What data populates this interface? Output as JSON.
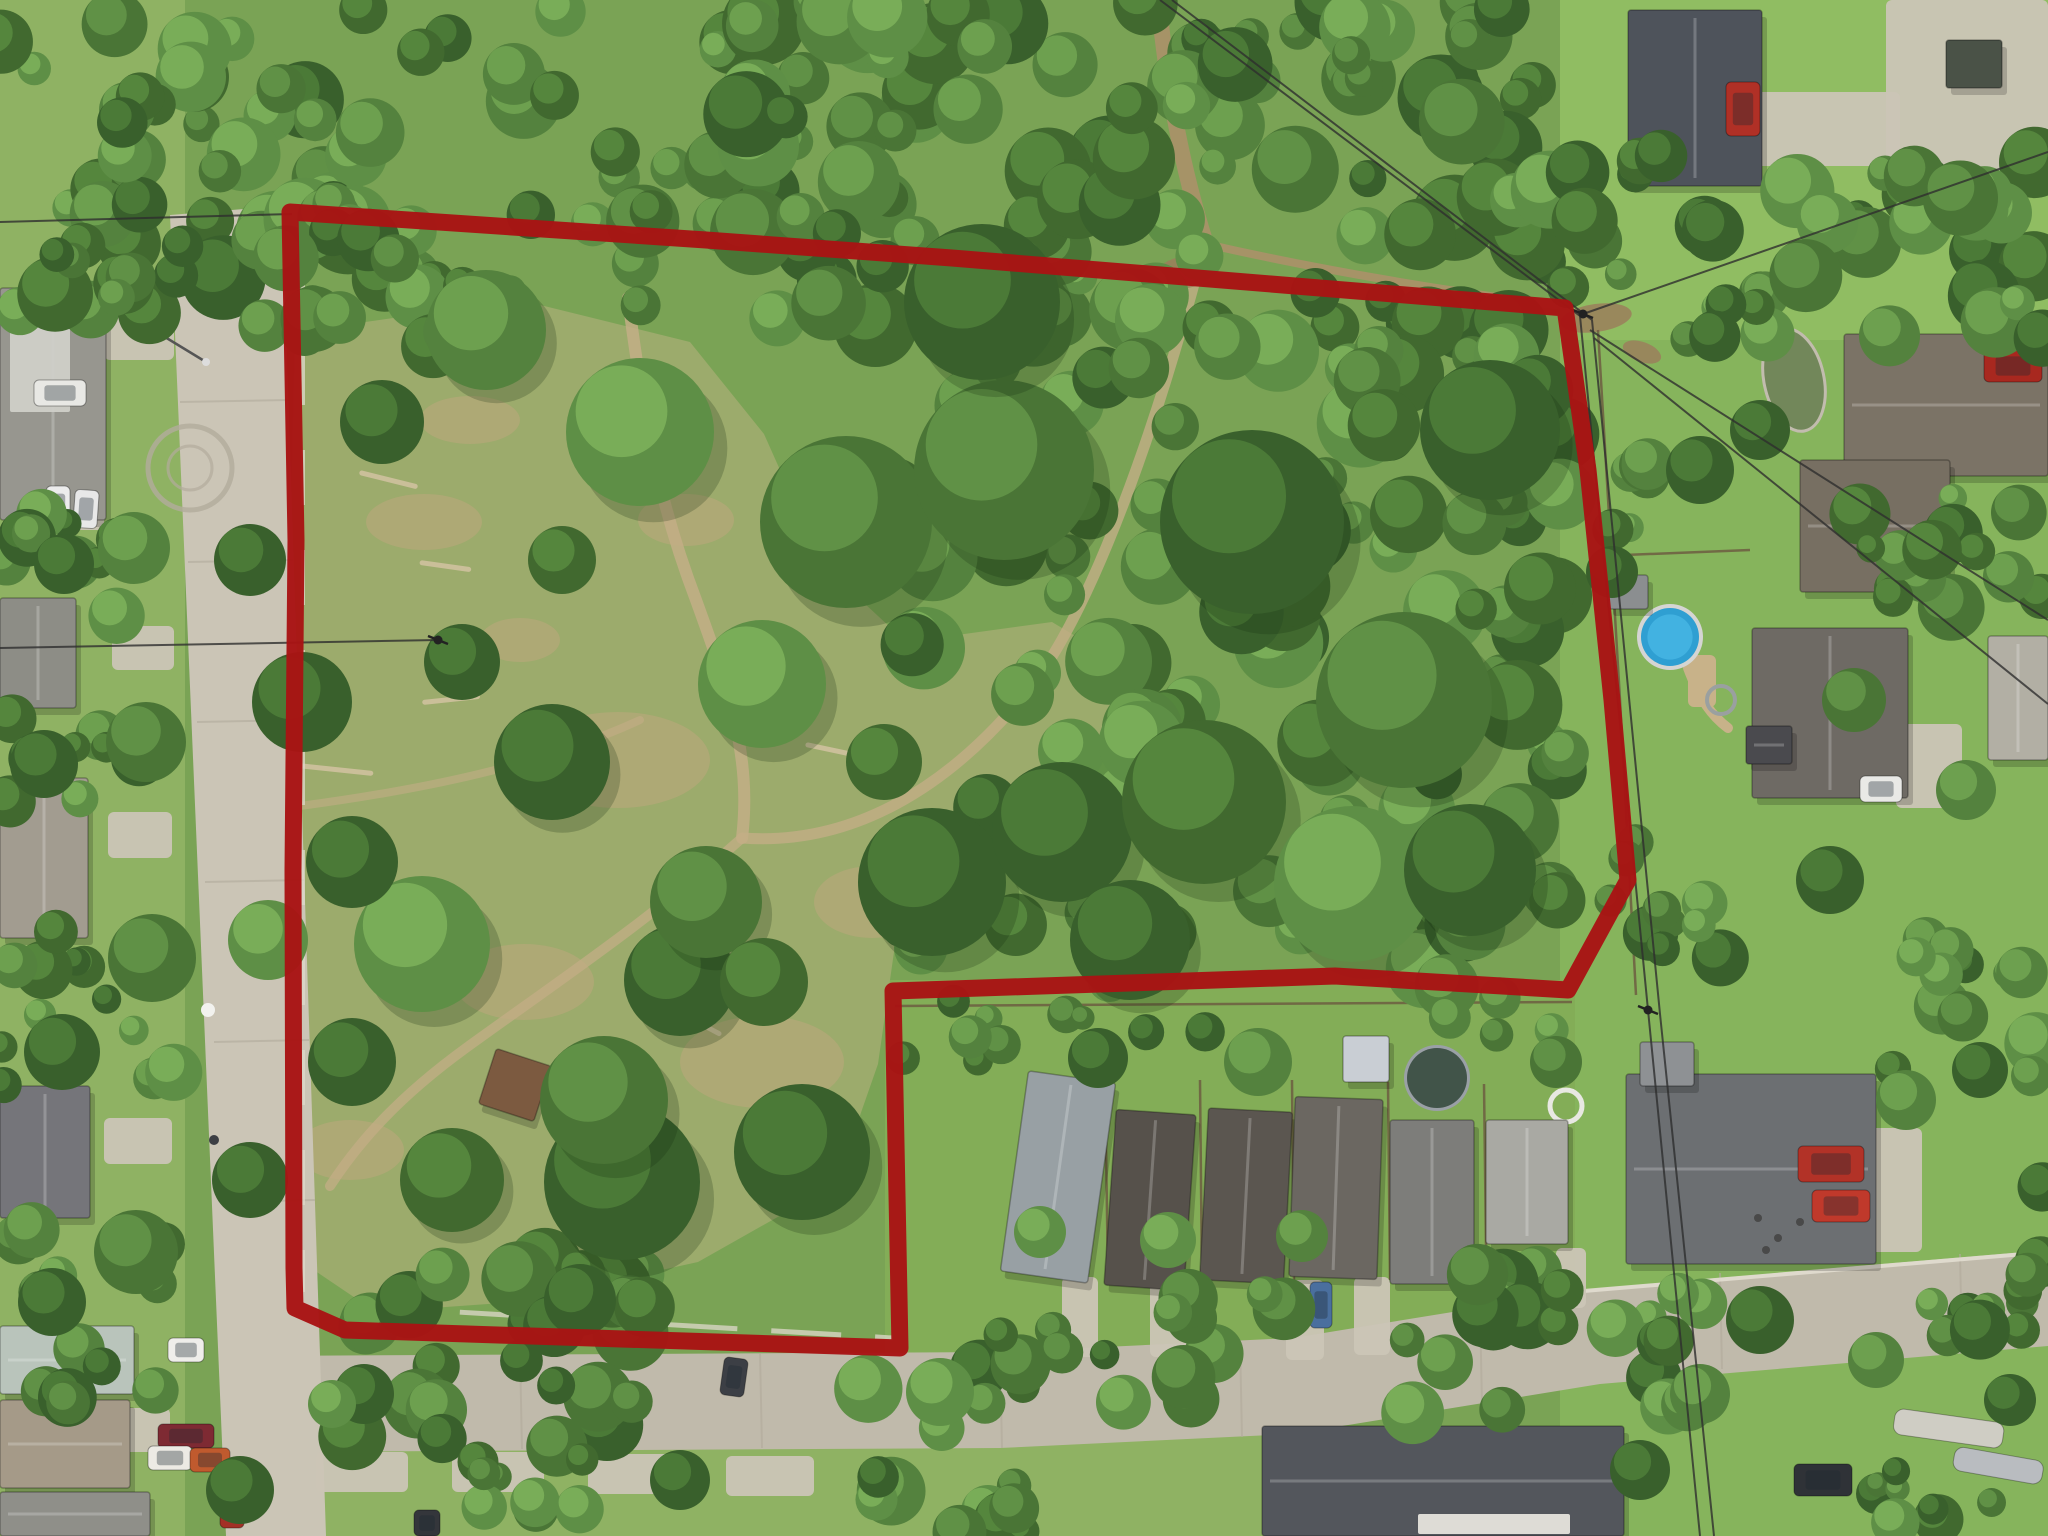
{
  "image": {
    "kind": "aerial-drone-photo",
    "width": 2048,
    "height": 1536,
    "description": "Aerial drone photo of a wooded vacant land parcel outlined with a thick dark-red boundary line, surrounded by suburban streets, houses, driveways, pools and lawns"
  },
  "palette": {
    "base": "#7aa355",
    "lawn_left": "#8fb263",
    "lawn_right": "#86b45c",
    "lawn_top_right": "#90bd62",
    "lawn_notch": "#83ad57",
    "clearing": "#9cab6c",
    "dry": "#bfa87e",
    "road": "#cbc5b6",
    "road_dark": "#c0baab",
    "curb": "#e3ded1",
    "seam": "#b2ab9c",
    "trail": "#c3ae86",
    "dirt": "#ab9169",
    "mud": "#9b7f5c",
    "log": "#cfc19f",
    "tree_dark": [
      "#39602c",
      "#41692f",
      "#4a7536",
      "#54823e",
      "#5e8f46"
    ],
    "tree_light": [
      "#4e7d39",
      "#58893f",
      "#639548",
      "#70a351",
      "#7cb05a"
    ],
    "boundary": "#a81414",
    "wire": "#2e2e2e",
    "fence": "#6b5740",
    "white_fence": "#ded9cb",
    "pool_water": "#2f9fd2",
    "pool_water_light": "#45b4e2",
    "pool_rim": "#d5d5d3",
    "dark_pool": "#415449",
    "dark_pool_rim": "#9aa0a6",
    "pond": "#72875a",
    "pond_rim": "#c2bcae",
    "deck": "#c8b289",
    "shadow": "rgba(0,0,0,0.18)",
    "ridge": "rgba(255,255,255,0.22)",
    "eave": "rgba(0,0,0,0.28)",
    "glass": "rgba(30,40,50,0.35)"
  },
  "boundary": {
    "stroke_width": 17,
    "points": [
      [
        290,
        212
      ],
      [
        706,
        240
      ],
      [
        952,
        258
      ],
      [
        1565,
        308
      ],
      [
        1588,
        470
      ],
      [
        1612,
        700
      ],
      [
        1628,
        880
      ],
      [
        1568,
        990
      ],
      [
        1335,
        976
      ],
      [
        893,
        991
      ],
      [
        900,
        1348
      ],
      [
        345,
        1330
      ],
      [
        295,
        1308
      ],
      [
        294,
        1268
      ],
      [
        293,
        870
      ],
      [
        296,
        540
      ]
    ]
  },
  "lawns": [
    [
      0,
      0,
      185,
      1536,
      "lawn_left"
    ],
    [
      1560,
      0,
      488,
      1536,
      "lawn_right"
    ],
    [
      1560,
      0,
      488,
      340,
      "lawn_top_right"
    ],
    [
      885,
      980,
      690,
      380,
      "lawn_notch"
    ],
    [
      230,
      1430,
      1330,
      106,
      "lawn_left"
    ]
  ],
  "clearing_path": "M295,332 L520,300 L690,342 L764,434 L822,564 L906,642 L1052,622 L1152,682 L1098,784 L962,834 L898,924 L878,1064 L836,1184 L698,1262 L516,1302 L376,1312 L302,1262 L284,802 Z",
  "dry_patches": [
    [
      618,
      760,
      92,
      48
    ],
    [
      524,
      982,
      70,
      38
    ],
    [
      762,
      1062,
      82,
      46
    ],
    [
      424,
      522,
      58,
      28
    ],
    [
      872,
      902,
      58,
      36
    ],
    [
      686,
      520,
      48,
      26
    ],
    [
      520,
      640,
      40,
      22
    ],
    [
      350,
      1150,
      54,
      30
    ],
    [
      470,
      420,
      50,
      24
    ]
  ],
  "trails": [
    {
      "d": "M628,298 C644,420 658,500 696,600 C728,688 752,756 742,838",
      "w": 12,
      "o": 0.85
    },
    {
      "d": "M742,838 C850,846 948,790 1030,688 C1094,608 1158,420 1200,262",
      "w": 11,
      "o": 0.8
    },
    {
      "d": "M742,838 C650,920 560,980 466,1048 C400,1096 360,1140 330,1186",
      "w": 10,
      "o": 0.75
    },
    {
      "d": "M300,806 C420,790 540,766 640,720",
      "w": 8,
      "o": 0.6
    }
  ],
  "dirt_paths": [
    {
      "d": "M1158,-6 C1166,84 1182,168 1206,244",
      "w": 16
    },
    {
      "d": "M1206,244 C1320,270 1450,292 1566,306",
      "w": 8
    }
  ],
  "mud_patches": [
    [
      1186,
      272,
      30,
      16,
      -8
    ],
    [
      1596,
      318,
      36,
      14,
      -8
    ],
    [
      1642,
      352,
      20,
      10,
      20
    ]
  ],
  "logs": [
    [
      742,
      688,
      74,
      -18
    ],
    [
      806,
      742,
      64,
      12
    ],
    [
      288,
      762,
      86,
      6
    ],
    [
      422,
      700,
      58,
      -6
    ],
    [
      868,
      906,
      54,
      20
    ],
    [
      680,
      1010,
      48,
      28
    ],
    [
      420,
      560,
      52,
      8
    ],
    [
      360,
      470,
      60,
      14
    ]
  ],
  "roads": {
    "left_street": "M170,215 L282,206 L326,1536 L226,1536 Z",
    "bottom_street": "M252,1356 L1000,1352 L1293,1338 L1600,1288 L2048,1250 L2048,1346 L1600,1384 L1293,1434 L1000,1448 L262,1452 Z",
    "seams": [
      [
        180,
        402,
        288,
        400
      ],
      [
        188,
        562,
        293,
        560
      ],
      [
        197,
        722,
        299,
        720
      ],
      [
        205,
        882,
        304,
        880
      ],
      [
        214,
        1042,
        309,
        1040
      ],
      [
        222,
        1202,
        315,
        1200
      ],
      [
        520,
        1354,
        522,
        1449
      ],
      [
        760,
        1353,
        762,
        1448
      ],
      [
        1000,
        1352,
        1002,
        1448
      ],
      [
        1240,
        1341,
        1242,
        1437
      ],
      [
        1480,
        1308,
        1482,
        1404
      ],
      [
        1720,
        1273,
        1722,
        1369
      ],
      [
        1960,
        1254,
        1962,
        1350
      ]
    ],
    "culdesac": {
      "cx": 190,
      "cy": 468,
      "r1": 42,
      "r2": 22
    },
    "curbs": [
      [
        1560,
        1293,
        2048,
        1252
      ]
    ]
  },
  "driveways": [
    [
      104,
      300,
      70,
      60
    ],
    [
      112,
      626,
      62,
      44
    ],
    [
      108,
      812,
      64,
      46
    ],
    [
      104,
      1118,
      68,
      46
    ],
    [
      100,
      1408,
      70,
      44
    ],
    [
      1754,
      92,
      146,
      74
    ],
    [
      1886,
      0,
      162,
      178
    ],
    [
      1896,
      724,
      66,
      84
    ],
    [
      1788,
      1128,
      134,
      124
    ],
    [
      1738,
      1198,
      96,
      66
    ],
    [
      1062,
      1277,
      36,
      80
    ],
    [
      1150,
      1283,
      38,
      74
    ],
    [
      1286,
      1280,
      38,
      80
    ],
    [
      1354,
      1277,
      36,
      78
    ],
    [
      1470,
      1260,
      32,
      66
    ],
    [
      1556,
      1248,
      30,
      60
    ],
    [
      316,
      1452,
      92,
      40
    ],
    [
      452,
      1452,
      92,
      40
    ],
    [
      588,
      1454,
      92,
      40
    ],
    [
      726,
      1456,
      88,
      40
    ],
    [
      40,
      486,
      64,
      44
    ]
  ],
  "white_fences": [
    {
      "x1": 303,
      "y1": 250,
      "x2": 303,
      "y2": 1292,
      "dash": "55 45",
      "w": 4
    },
    {
      "x1": 356,
      "y1": 1306,
      "x2": 893,
      "y2": 1338,
      "dash": "70 34",
      "w": 5
    }
  ],
  "fences": [
    [
      [
        1598,
        330
      ],
      [
        1620,
        700
      ],
      [
        1636,
        995
      ]
    ],
    [
      [
        895,
        1006
      ],
      [
        1572,
        1002
      ]
    ],
    [
      [
        1105,
        1077
      ],
      [
        1108,
        1280
      ]
    ],
    [
      [
        1200,
        1080
      ],
      [
        1202,
        1282
      ]
    ],
    [
      [
        1292,
        1080
      ],
      [
        1294,
        1280
      ]
    ],
    [
      [
        1388,
        1082
      ],
      [
        1390,
        1280
      ]
    ],
    [
      [
        1484,
        1084
      ],
      [
        1486,
        1246
      ]
    ],
    [
      [
        1600,
        556
      ],
      [
        1750,
        550
      ]
    ]
  ],
  "pond": {
    "cx": 1794,
    "cy": 380,
    "rx": 30,
    "ry": 52,
    "rot": -12
  },
  "pools": {
    "blue": {
      "cx": 1670,
      "cy": 637,
      "r": 29
    },
    "deck": [
      1688,
      655,
      28,
      52
    ],
    "slide": {
      "d": "M1688,668 C1700,700 1712,716 1728,728",
      "w": 10
    },
    "dark": {
      "cx": 1437,
      "cy": 1078,
      "r": 30
    },
    "trampoline": {
      "cx": 1721,
      "cy": 700,
      "r": 14
    },
    "white_ring": {
      "cx": 1566,
      "cy": 1106,
      "r": 16
    }
  },
  "houses": [
    [
      0,
      288,
      106,
      232,
      0,
      "#97968f"
    ],
    [
      0,
      598,
      76,
      110,
      0,
      "#8d8d86"
    ],
    [
      0,
      778,
      88,
      160,
      0,
      "#a29c90"
    ],
    [
      0,
      1086,
      90,
      132,
      0,
      "#75757a"
    ],
    [
      0,
      1326,
      134,
      68,
      0,
      "#b9c4bb"
    ],
    [
      0,
      1400,
      130,
      88,
      0,
      "#a59a88"
    ],
    [
      0,
      1492,
      150,
      44,
      0,
      "#8f8f89"
    ],
    [
      1628,
      10,
      134,
      176,
      0,
      "#4e535b"
    ],
    [
      1844,
      334,
      204,
      142,
      0,
      "#7b7366"
    ],
    [
      1800,
      460,
      150,
      132,
      0,
      "#776f62"
    ],
    [
      1752,
      628,
      156,
      170,
      0,
      "#6e6a64"
    ],
    [
      1746,
      726,
      46,
      38,
      0,
      "#4a4a4e"
    ],
    [
      1626,
      1074,
      250,
      190,
      0,
      "#6c6f72"
    ],
    [
      1262,
      1426,
      362,
      110,
      0,
      "#53565c"
    ],
    [
      1988,
      636,
      60,
      124,
      0,
      "#b2afa4"
    ],
    [
      1014,
      1076,
      88,
      202,
      8,
      "#98a0a4"
    ],
    [
      1110,
      1112,
      80,
      176,
      4,
      "#56514b"
    ],
    [
      1204,
      1110,
      84,
      172,
      3,
      "#5b5650"
    ],
    [
      1292,
      1098,
      88,
      180,
      2,
      "#6b6761"
    ],
    [
      1390,
      1120,
      84,
      164,
      0,
      "#7d7d7a"
    ],
    [
      1486,
      1120,
      82,
      124,
      0,
      "#a9a9a3"
    ]
  ],
  "house_details": [
    [
      10,
      292,
      60,
      120,
      "#cfcfc8"
    ],
    [
      1418,
      1514,
      152,
      20,
      "#e6e4dc"
    ]
  ],
  "sheds": [
    [
      486,
      1056,
      58,
      58,
      18,
      "#7c5a40"
    ],
    [
      1343,
      1036,
      46,
      46,
      0,
      "#c9ced4"
    ],
    [
      1640,
      1042,
      54,
      44,
      0,
      "#8e9194"
    ],
    [
      1946,
      40,
      56,
      48,
      0,
      "#4a5247"
    ],
    [
      1608,
      575,
      40,
      34,
      0,
      "#8b8e90"
    ]
  ],
  "vehicles": [
    [
      46,
      486,
      24,
      38,
      0,
      "#ececec"
    ],
    [
      74,
      490,
      24,
      38,
      4,
      "#e8e8e8"
    ],
    [
      34,
      380,
      52,
      26,
      0,
      "#e8e8e4"
    ],
    [
      168,
      1338,
      36,
      24,
      0,
      "#efeeea"
    ],
    [
      158,
      1424,
      56,
      24,
      0,
      "#7e2a33"
    ],
    [
      148,
      1446,
      44,
      24,
      0,
      "#eceae4"
    ],
    [
      190,
      1448,
      40,
      24,
      0,
      "#c05a2e"
    ],
    [
      220,
      1484,
      24,
      44,
      0,
      "#a33026"
    ],
    [
      722,
      1358,
      24,
      38,
      8,
      "#3c3f45"
    ],
    [
      414,
      1510,
      26,
      26,
      0,
      "#34363b"
    ],
    [
      1726,
      82,
      34,
      54,
      0,
      "#b03026"
    ],
    [
      1984,
      350,
      58,
      32,
      0,
      "#a8281f"
    ],
    [
      1860,
      776,
      42,
      26,
      0,
      "#e9e9e6"
    ],
    [
      1310,
      1282,
      22,
      46,
      0,
      "#4a6f9e"
    ],
    [
      1798,
      1146,
      66,
      36,
      0,
      "#b23227"
    ],
    [
      1812,
      1190,
      58,
      32,
      0,
      "#c0392b"
    ],
    [
      1794,
      1464,
      58,
      32,
      0,
      "#2f3237"
    ]
  ],
  "boats": [
    [
      1896,
      1408,
      110,
      26,
      8,
      "#cfcdc4"
    ],
    [
      1956,
      1446,
      90,
      24,
      10,
      "#b9bcc0"
    ]
  ],
  "objects": [
    [
      208,
      1010,
      7,
      "#f2f2ee"
    ],
    [
      214,
      1140,
      5,
      "#3d3f44"
    ],
    [
      220,
      1186,
      5,
      "#3d3f44"
    ],
    [
      353,
      1398,
      5,
      "#6b6458"
    ],
    [
      1758,
      1218,
      4,
      "#494949"
    ],
    [
      1778,
      1238,
      4,
      "#494949"
    ],
    [
      1800,
      1222,
      4,
      "#494949"
    ],
    [
      1766,
      1250,
      4,
      "#494949"
    ]
  ],
  "streetlight": {
    "x1": 160,
    "y1": 334,
    "x2": 206,
    "y2": 362
  },
  "forest_regions": [
    [
      175,
      0,
      1395,
      330,
      150,
      18,
      44
    ],
    [
      285,
      196,
      255,
      168,
      26,
      16,
      34
    ],
    [
      893,
      300,
      680,
      690,
      115,
      20,
      46
    ],
    [
      0,
      0,
      185,
      318,
      26,
      16,
      38
    ],
    [
      0,
      508,
      160,
      120,
      9,
      14,
      30
    ],
    [
      0,
      690,
      165,
      120,
      10,
      14,
      30
    ],
    [
      0,
      928,
      175,
      166,
      13,
      14,
      32
    ],
    [
      0,
      1225,
      175,
      180,
      12,
      14,
      32
    ],
    [
      898,
      996,
      665,
      70,
      14,
      10,
      22
    ],
    [
      352,
      1262,
      340,
      186,
      26,
      18,
      40
    ],
    [
      815,
      1368,
      210,
      168,
      15,
      16,
      36
    ],
    [
      462,
      1458,
      130,
      78,
      8,
      14,
      26
    ],
    [
      990,
      1283,
      300,
      130,
      14,
      14,
      32
    ],
    [
      1395,
      1266,
      180,
      162,
      12,
      16,
      36
    ],
    [
      1758,
      138,
      290,
      204,
      27,
      16,
      38
    ],
    [
      1565,
      148,
      205,
      192,
      18,
      14,
      34
    ],
    [
      1852,
      468,
      196,
      162,
      14,
      14,
      34
    ],
    [
      1608,
      842,
      126,
      132,
      10,
      14,
      30
    ],
    [
      1888,
      928,
      160,
      152,
      13,
      14,
      32
    ],
    [
      1928,
      1168,
      120,
      172,
      11,
      14,
      30
    ],
    [
      1558,
      1278,
      155,
      152,
      11,
      14,
      30
    ],
    [
      1876,
      1458,
      172,
      78,
      8,
      12,
      26
    ],
    [
      1592,
      436,
      80,
      96,
      6,
      12,
      26
    ]
  ],
  "trees": [
    [
      640,
      432,
      74
    ],
    [
      846,
      522,
      86
    ],
    [
      1004,
      470,
      90
    ],
    [
      762,
      684,
      64
    ],
    [
      932,
      882,
      74
    ],
    [
      1062,
      832,
      70
    ],
    [
      552,
      762,
      58
    ],
    [
      422,
      944,
      68
    ],
    [
      622,
      1182,
      78
    ],
    [
      802,
      1152,
      68
    ],
    [
      982,
      302,
      78
    ],
    [
      1252,
      522,
      92
    ],
    [
      1404,
      700,
      88
    ],
    [
      1204,
      802,
      82
    ],
    [
      1352,
      884,
      78
    ],
    [
      486,
      330,
      60
    ],
    [
      1490,
      430,
      70
    ],
    [
      1470,
      870,
      66
    ],
    [
      1130,
      940,
      60
    ],
    [
      680,
      980,
      56
    ],
    [
      382,
      422,
      42
    ],
    [
      302,
      702,
      50
    ],
    [
      462,
      662,
      38
    ],
    [
      352,
      862,
      46
    ],
    [
      562,
      560,
      34
    ],
    [
      706,
      902,
      56
    ],
    [
      604,
      1100,
      64
    ],
    [
      452,
      1180,
      52
    ],
    [
      764,
      982,
      44
    ],
    [
      884,
      762,
      38
    ],
    [
      352,
      1062,
      44
    ],
    [
      250,
      560,
      36
    ],
    [
      268,
      940,
      40
    ],
    [
      250,
      1180,
      38
    ],
    [
      1098,
      1058,
      30
    ],
    [
      1258,
      1062,
      34
    ],
    [
      1556,
      1062,
      26
    ],
    [
      1040,
      1232,
      26
    ],
    [
      1168,
      1240,
      28
    ],
    [
      1302,
      1236,
      26
    ],
    [
      134,
      548,
      36
    ],
    [
      64,
      564,
      30
    ],
    [
      146,
      742,
      40
    ],
    [
      44,
      764,
      34
    ],
    [
      152,
      958,
      44
    ],
    [
      62,
      1052,
      38
    ],
    [
      136,
      1252,
      42
    ],
    [
      52,
      1302,
      34
    ],
    [
      1612,
      572,
      26
    ],
    [
      1700,
      470,
      34
    ],
    [
      1760,
      430,
      30
    ],
    [
      1854,
      700,
      32
    ],
    [
      1966,
      790,
      30
    ],
    [
      1830,
      880,
      34
    ],
    [
      1906,
      1100,
      30
    ],
    [
      1980,
      1070,
      28
    ],
    [
      1760,
      1320,
      34
    ],
    [
      1700,
      1394,
      30
    ],
    [
      1876,
      1360,
      28
    ],
    [
      2010,
      1400,
      26
    ],
    [
      1640,
      1470,
      30
    ],
    [
      940,
      1392,
      34
    ],
    [
      580,
      1300,
      36
    ],
    [
      240,
      1490,
      34
    ],
    [
      680,
      1480,
      30
    ],
    [
      364,
      1394,
      30
    ],
    [
      332,
      1404,
      24
    ]
  ],
  "power_lines": [
    [
      [
        1160,
        0
      ],
      [
        1580,
        316
      ],
      [
        1648,
        1010
      ],
      [
        1700,
        1536
      ]
    ],
    [
      [
        1172,
        0
      ],
      [
        1592,
        320
      ],
      [
        1660,
        1014
      ],
      [
        1714,
        1536
      ]
    ],
    [
      [
        1583,
        314
      ],
      [
        2048,
        152
      ]
    ],
    [
      [
        1590,
        330
      ],
      [
        2048,
        620
      ]
    ],
    [
      [
        1594,
        338
      ],
      [
        2048,
        704
      ]
    ],
    [
      [
        0,
        222
      ],
      [
        292,
        214
      ]
    ],
    [
      [
        0,
        648
      ],
      [
        438,
        640
      ]
    ]
  ],
  "poles": [
    [
      1583,
      314
    ],
    [
      1648,
      1010
    ],
    [
      438,
      640
    ]
  ]
}
